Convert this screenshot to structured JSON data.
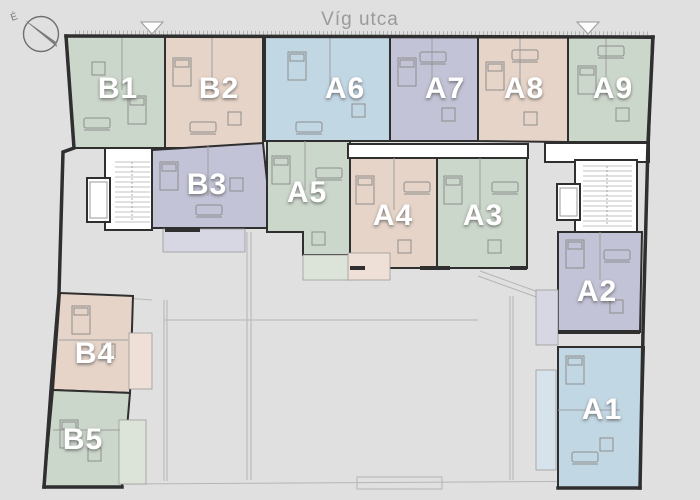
{
  "street": {
    "label": "Víg utca"
  },
  "compass": {
    "north_label": "É"
  },
  "palette": {
    "background": "#e0e0e0",
    "wall": "#2f2f2f",
    "label_text": "#ffffff",
    "street_text": "#9a9a9a",
    "compass_stroke": "#6f6f6f",
    "green": "#cbd7ca",
    "green_light": "#dce4d9",
    "pink": "#e6d4c8",
    "pink_light": "#eee0d6",
    "blue": "#c2d7e4",
    "blue_light": "#d7e3eb",
    "lavender": "#c2c3d6",
    "lavender_light": "#d6d7e2",
    "entrance_marker_fill": "#fdfdfd",
    "entrance_marker_stroke": "#9a9a9a"
  },
  "icons": {
    "compass": "compass-north-icon",
    "entrance_marker": "triangle-down-entrance-icon",
    "elevator": "elevator-shaft-icon",
    "stairs": "staircase-icon"
  },
  "units": [
    {
      "id": "B1",
      "label": "B1",
      "color": "#cbd7ca"
    },
    {
      "id": "B2",
      "label": "B2",
      "color": "#e6d4c8"
    },
    {
      "id": "A6",
      "label": "A6",
      "color": "#c2d7e4"
    },
    {
      "id": "A7",
      "label": "A7",
      "color": "#c2c3d6"
    },
    {
      "id": "A8",
      "label": "A8",
      "color": "#e6d4c8"
    },
    {
      "id": "A9",
      "label": "A9",
      "color": "#cbd7ca"
    },
    {
      "id": "B3",
      "label": "B3",
      "color": "#c2c3d6"
    },
    {
      "id": "A5",
      "label": "A5",
      "color": "#cbd7ca"
    },
    {
      "id": "A4",
      "label": "A4",
      "color": "#e6d4c8"
    },
    {
      "id": "A3",
      "label": "A3",
      "color": "#cbd7ca"
    },
    {
      "id": "A2",
      "label": "A2",
      "color": "#c2c3d6"
    },
    {
      "id": "A1",
      "label": "A1",
      "color": "#c2d7e4"
    },
    {
      "id": "B4",
      "label": "B4",
      "color": "#e6d4c8"
    },
    {
      "id": "B5",
      "label": "B5",
      "color": "#cbd7ca"
    }
  ]
}
